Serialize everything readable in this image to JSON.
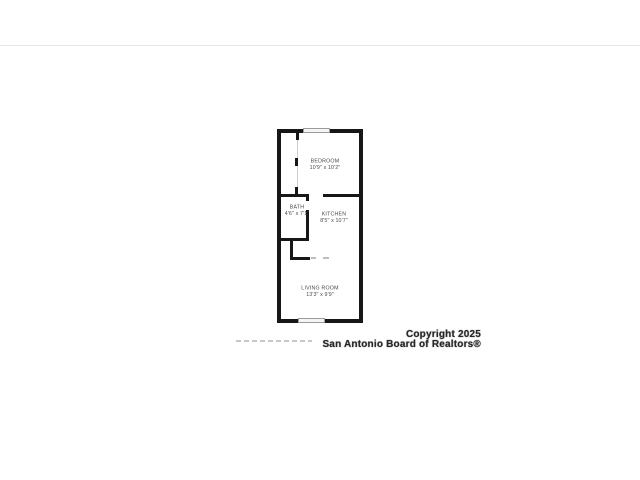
{
  "canvas": {
    "background": "#ffffff",
    "divider_color": "#e7e7e7"
  },
  "floor_plan": {
    "wall_color": "#171717",
    "window_color": "#f5f5f5",
    "label_color": "#4a4a4a",
    "rooms": [
      {
        "name": "BEDROOM",
        "dimensions": "10'9\" x 10'2\""
      },
      {
        "name": "BATH",
        "dimensions": "4'6\" x 7'1\""
      },
      {
        "name": "KITCHEN",
        "dimensions": "8'5\" x 10'7\""
      },
      {
        "name": "LIVING ROOM",
        "dimensions": "13'3\" x 9'9\""
      }
    ]
  },
  "watermark": {
    "line1": "Copyright 2025",
    "line2": "San Antonio Board of Realtors®"
  }
}
